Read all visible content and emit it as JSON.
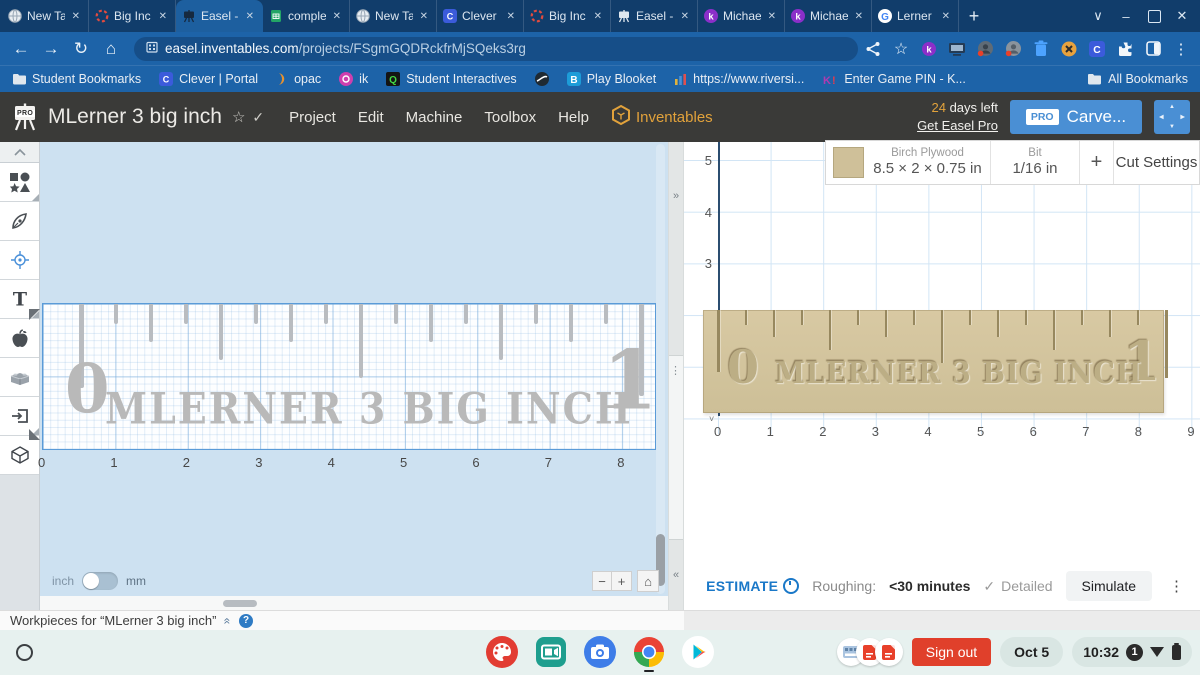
{
  "colors": {
    "tabbar_bg": "#113d6b",
    "chrome_blue": "#1d63a8",
    "url_pill": "#164e88",
    "easel_header_bg": "#3a3a38",
    "accent_orange": "#e2a23b",
    "carve_blue": "#4a8fd4",
    "canvas_blue": "#cde1f1",
    "design_gray": "#b9b9b9",
    "wood": "#d5c69f",
    "estimate_blue": "#1a78c8",
    "signout_red": "#e0402b",
    "shelf_bg": "#e7f1ef"
  },
  "browser": {
    "tabs": [
      {
        "label": "New Ta",
        "icon": "globe",
        "active": false
      },
      {
        "label": "Big Inc",
        "icon": "rec",
        "active": false
      },
      {
        "label": "Easel -",
        "icon": "easel",
        "active": true
      },
      {
        "label": "comple",
        "icon": "sheets",
        "active": false
      },
      {
        "label": "New Ta",
        "icon": "globe",
        "active": false
      },
      {
        "label": "Clever |",
        "icon": "clever",
        "active": false
      },
      {
        "label": "Big Inc",
        "icon": "rec",
        "active": false
      },
      {
        "label": "Easel -",
        "icon": "easel",
        "active": false
      },
      {
        "label": "Michae",
        "icon": "kami",
        "active": false
      },
      {
        "label": "Michae",
        "icon": "kami",
        "active": false
      },
      {
        "label": "Lerner",
        "icon": "google",
        "active": false
      }
    ],
    "close_glyph": "✕",
    "new_tab": "+",
    "window_controls": {
      "tab_search": "∨",
      "minimize": "–",
      "close": "✕"
    },
    "nav": {
      "back": "←",
      "forward": "→",
      "reload": "↻",
      "home": "⌂"
    },
    "url_host": "easel.inventables.com",
    "url_path": "/projects/FSgmGQDRckfrMjSQeks3rg",
    "actions": [
      "share",
      "bookmark-star",
      "kami",
      "cast",
      "profile-a",
      "profile-b",
      "trash",
      "blocksite",
      "clever",
      "extensions",
      "split-screen",
      "menu"
    ]
  },
  "bookmarks": {
    "items": [
      {
        "label": "Student Bookmarks",
        "icon": "folder"
      },
      {
        "label": "Clever | Portal",
        "icon": "clever"
      },
      {
        "label": "opac",
        "icon": "opac"
      },
      {
        "label": "ik",
        "icon": "ik"
      },
      {
        "label": "Student Interactives",
        "icon": "qube"
      },
      {
        "label": "",
        "icon": "globe-dark"
      },
      {
        "label": "Play Blooket",
        "icon": "blooket"
      },
      {
        "label": "https://www.riversi...",
        "icon": "chart"
      },
      {
        "label": "Enter Game PIN - K...",
        "icon": "kahoot"
      }
    ],
    "all_bookmarks": "All Bookmarks"
  },
  "easel": {
    "title": "MLerner 3 big inch",
    "star": "☆",
    "check": "✓",
    "menus": [
      "Project",
      "Edit",
      "Machine",
      "Toolbox",
      "Help"
    ],
    "brand": "Inventables",
    "days_left_num": "24",
    "days_left_text": " days left",
    "get_pro": "Get Easel Pro",
    "pro_badge": "PRO",
    "carve": "Carve...",
    "tools": [
      "collapse",
      "shapes",
      "pen",
      "origin",
      "text",
      "apps",
      "material",
      "import",
      "cube"
    ]
  },
  "canvas": {
    "x_ticks": [
      "0",
      "1",
      "2",
      "3",
      "4",
      "5",
      "6",
      "7",
      "8"
    ],
    "unit_left": "inch",
    "unit_right": "mm",
    "zoom": {
      "out": "−",
      "in": "+",
      "home": "⌂"
    }
  },
  "design": {
    "numeral_left": "0",
    "numeral_right": "1",
    "label": "MLERNER 3 BIG INCH",
    "tick_levels": [
      4,
      0,
      1,
      0,
      2,
      0,
      1,
      0,
      3,
      0,
      1,
      0,
      2,
      0,
      1,
      0,
      5
    ]
  },
  "divider": {
    "expand": "»",
    "handle": "⋮",
    "collapse": "«"
  },
  "preview": {
    "y_ticks": [
      "5",
      "4",
      "3"
    ],
    "x_ticks": [
      "0",
      "1",
      "2",
      "3",
      "4",
      "5",
      "6",
      "7",
      "8",
      "9"
    ],
    "material_name": "Birch Plywood",
    "material_size": "8.5 × 2 × 0.75 in",
    "bit_label": "Bit",
    "bit_size": "1/16 in",
    "add_bit": "+",
    "cut_settings": "Cut Settings",
    "origin_caret": "˅"
  },
  "estimate": {
    "label": "ESTIMATE",
    "roughing_label": "Roughing:",
    "roughing_value": "<30 minutes",
    "check": "✓",
    "detailed": "Detailed",
    "simulate": "Simulate",
    "menu": "⋮"
  },
  "workpieces": {
    "label": "Workpieces for “MLerner 3 big inch”",
    "collapse_glyph": "«",
    "help": "?"
  },
  "shelf": {
    "sign_out": "Sign out",
    "date": "Oct 5",
    "time": "10:32",
    "notification_count": "1",
    "apps": [
      "canvas-app",
      "screencast-app",
      "camera-app",
      "chrome-app",
      "play-store-app"
    ]
  }
}
